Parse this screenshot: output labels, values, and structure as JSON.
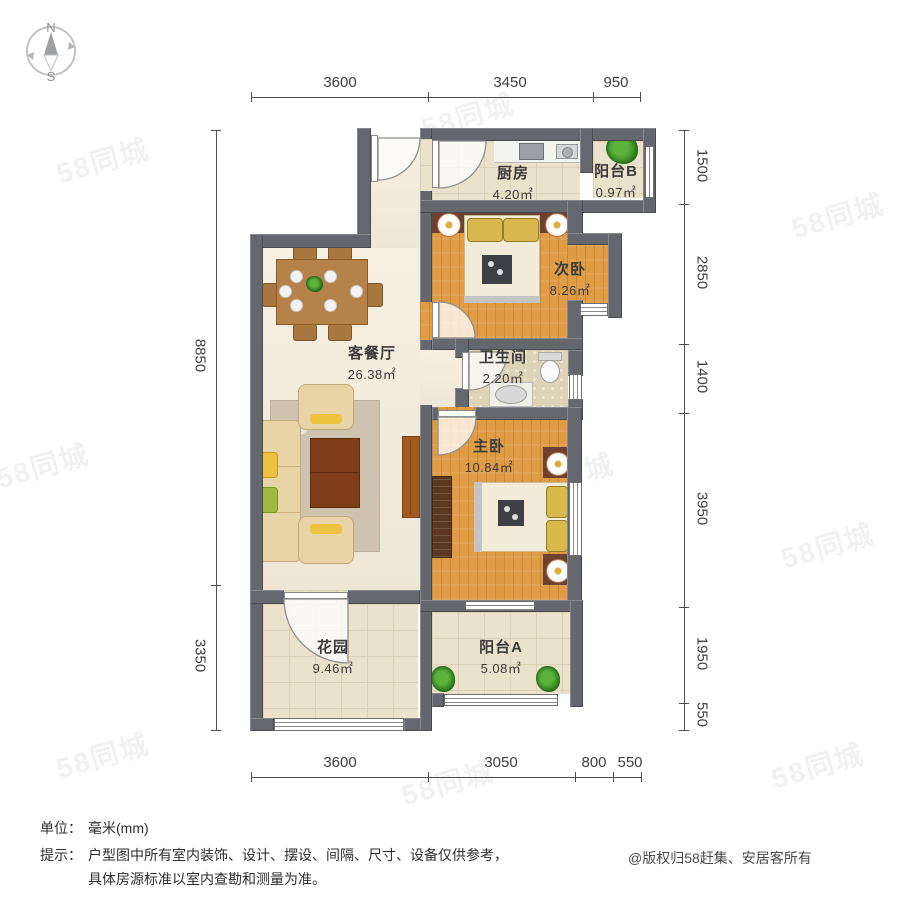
{
  "compass": {
    "north_label": "N",
    "south_label": "S"
  },
  "dims": {
    "top": [
      "3600",
      "3450",
      "950"
    ],
    "bottom": [
      "3600",
      "3050",
      "800",
      "550"
    ],
    "left": [
      "8850",
      "3350"
    ],
    "right": [
      "1500",
      "2850",
      "1400",
      "3950",
      "1950",
      "550"
    ]
  },
  "rooms": {
    "kitchen": {
      "name": "厨房",
      "area": "4.20㎡"
    },
    "balcony_b": {
      "name": "阳台B",
      "area": "0.97㎡"
    },
    "second_bedroom": {
      "name": "次卧",
      "area": "8.26㎡"
    },
    "living_dining": {
      "name": "客餐厅",
      "area": "26.38㎡"
    },
    "bathroom": {
      "name": "卫生间",
      "area": "2.20㎡"
    },
    "master_bedroom": {
      "name": "主卧",
      "area": "10.84㎡"
    },
    "garden": {
      "name": "花园",
      "area": "9.46㎡"
    },
    "balcony_a": {
      "name": "阳台A",
      "area": "5.08㎡"
    }
  },
  "footer": {
    "unit_label": "单位：",
    "unit_value": "毫米(mm)",
    "tip_label": "提示：",
    "tip_line1": "户型图中所有室内装饰、设计、摆设、间隔、尺寸、设备仅供参考，",
    "tip_line2": "具体房源标准以室内查勘和测量为准。",
    "copyright": "@版权归58赶集、安居客所有"
  },
  "watermark": {
    "text": "58同城"
  },
  "colors": {
    "wall": "#64676d",
    "wood_floor": "#e09c45",
    "tile_floor": "#ebe2cb",
    "living_floor": "#f4ebd9",
    "headboard": "#6e4030"
  }
}
